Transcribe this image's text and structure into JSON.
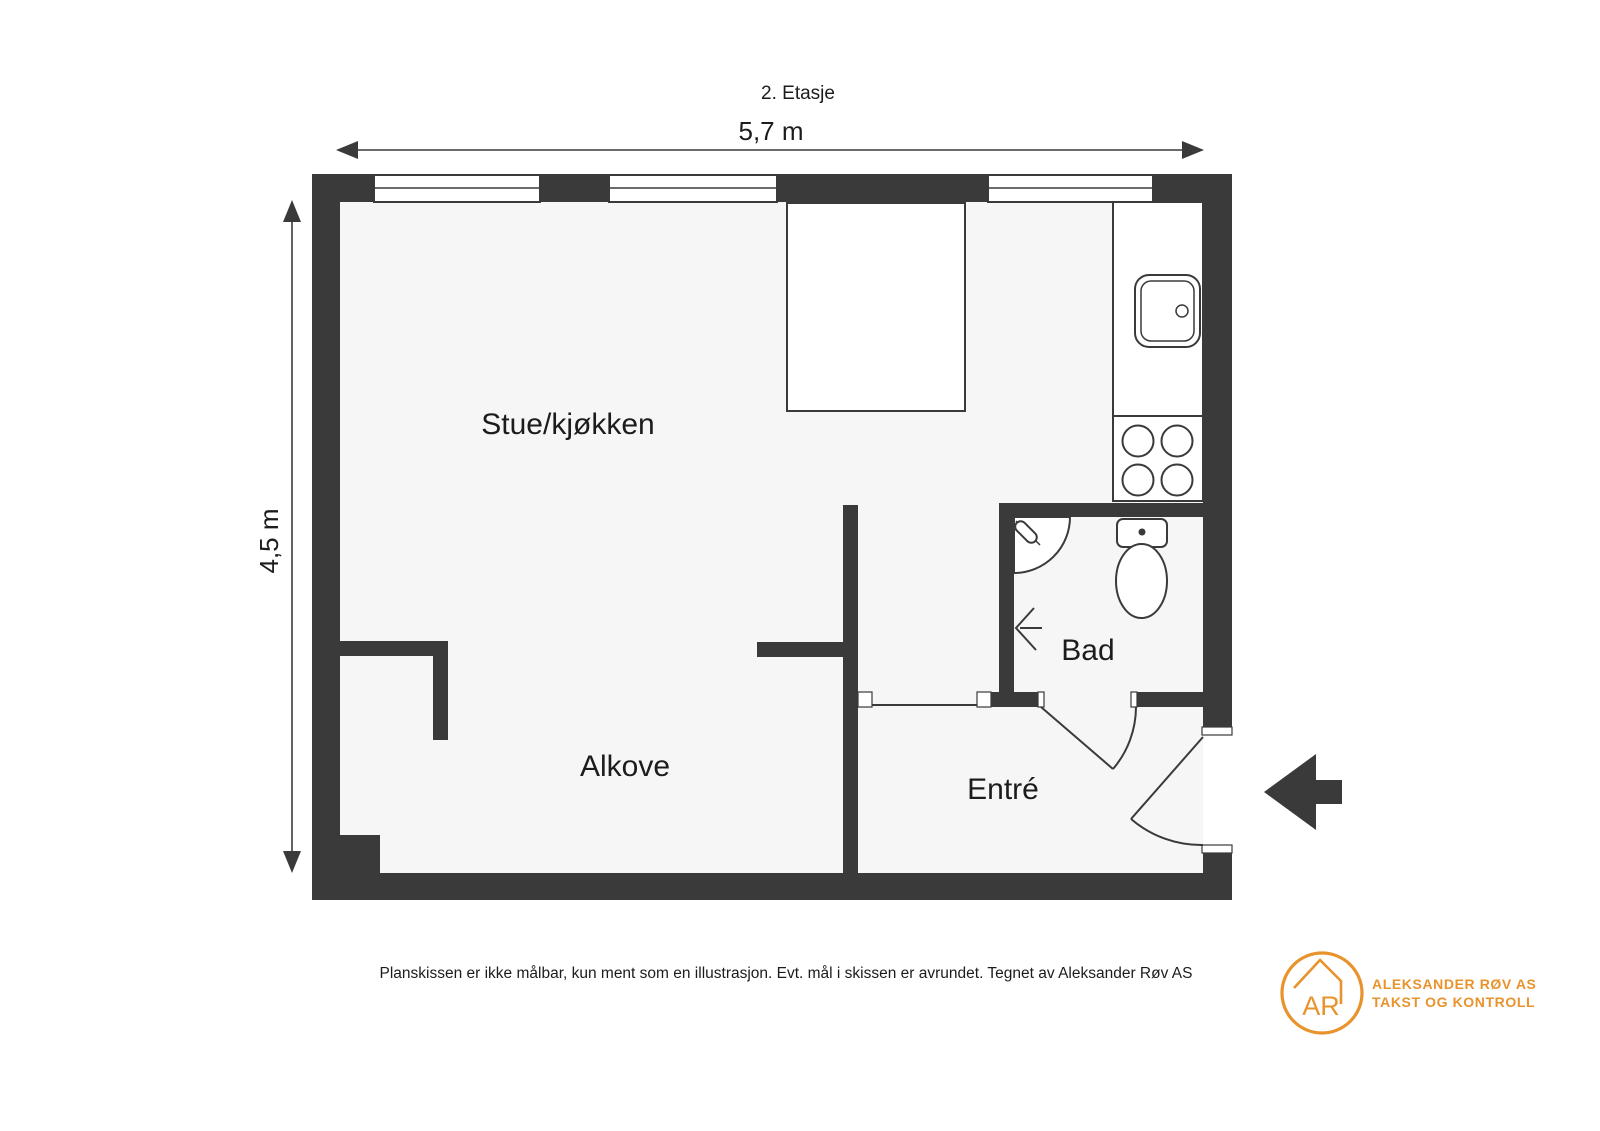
{
  "title": "2. Etasje",
  "dimensions": {
    "width_label": "5,7 m",
    "height_label": "4,5 m"
  },
  "rooms": {
    "living_kitchen": "Stue/kjøkken",
    "alcove": "Alkove",
    "bathroom": "Bad",
    "entrance": "Entré"
  },
  "footer": {
    "disclaimer": "Planskissen er ikke målbar, kun ment som en illustrasjon. Evt. mål i skissen er avrundet. Tegnet av Aleksander Røv AS"
  },
  "logo": {
    "monogram": "AR",
    "company_name": "ALEKSANDER RØV AS",
    "company_tagline": "TAKST OG KONTROLL"
  },
  "colors": {
    "wall": "#3a3a3a",
    "floor": "#f6f6f7",
    "fixture_fill": "#ffffff",
    "brand_orange": "#e8932c",
    "text": "#1c1c1c"
  }
}
